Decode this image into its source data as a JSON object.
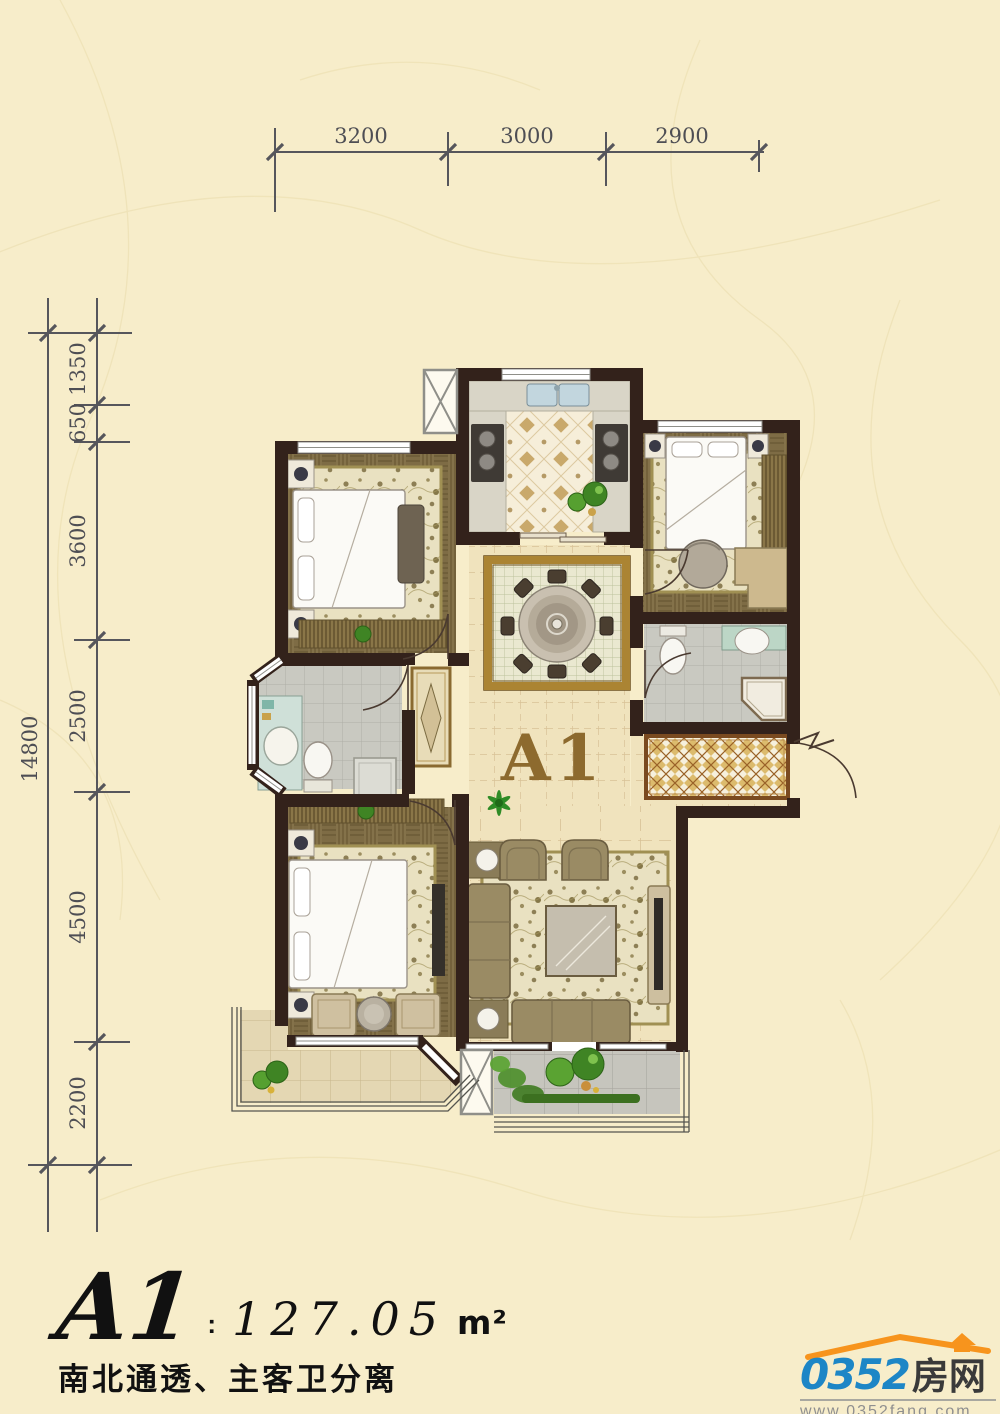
{
  "page": {
    "background": "#f7edca"
  },
  "dimensions": {
    "top": {
      "segments": [
        "3200",
        "3000",
        "2900"
      ]
    },
    "left": {
      "segments": [
        "1350",
        "650",
        "3600",
        "2500",
        "4500",
        "2200"
      ],
      "total": "14800"
    }
  },
  "plan": {
    "unit_label": "A1"
  },
  "footer": {
    "unit": "A1",
    "colon": ":",
    "area": "127.05",
    "area_unit": "m²",
    "tagline": "南北通透、主客卫分离"
  },
  "logo": {
    "brand_number": "0352",
    "brand_cn": "房网",
    "website": "www.0352fang.com"
  },
  "colors": {
    "wall": "#33221b",
    "dimension_line": "#56565c",
    "unit_label": "#8d6a2e",
    "logo_blue": "#1d86c6",
    "logo_orange": "#f7941d"
  }
}
